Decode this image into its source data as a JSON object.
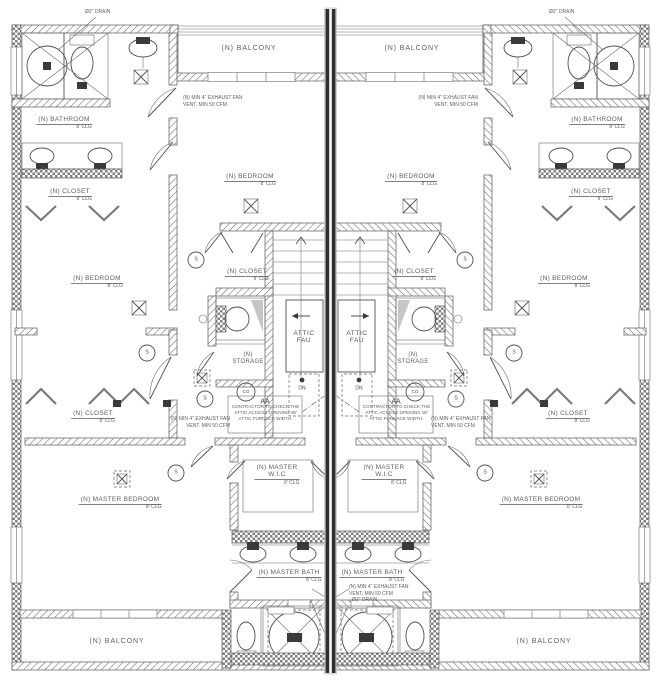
{
  "labels": {
    "balcony": "(N) BALCONY",
    "bathroom": "(N) BATHROOM",
    "bedroom": "(N) BEDROOM",
    "closet": "(N) CLOSET",
    "storage_l1": "(N)",
    "storage_l2": "STORAGE",
    "master_bedroom": "(N) MASTER BEDROOM",
    "master_wic_l1": "(N) MASTER",
    "master_wic_l2": "W.I.C",
    "master_bath": "(N) MASTER BATH",
    "attic_l1": "ATTIC",
    "attic_l2": "FAU",
    "clg": "8' CLG",
    "dn": "DN",
    "aa": "AA",
    "smoke": "S",
    "co": "CO"
  },
  "notes": {
    "drain": "Ø2\" DRAIN",
    "exhaust_l1": "(N) MIN 4\" EXHAUST FAN",
    "exhaust_l2": "VENT. MIN 50 CFM",
    "contractor_l1": "CONTRACTOR TO CHECK THE",
    "contractor_l2": "ATTIC ACCESS OPENING W/",
    "contractor_l3": "ATTIC FURNACE WIDTH."
  },
  "colors": {
    "linework": "#4f4f4f",
    "party_wall": "#2f2f2f",
    "text": "#5f5f5f",
    "wall_hatch": "#6e6e6e"
  }
}
